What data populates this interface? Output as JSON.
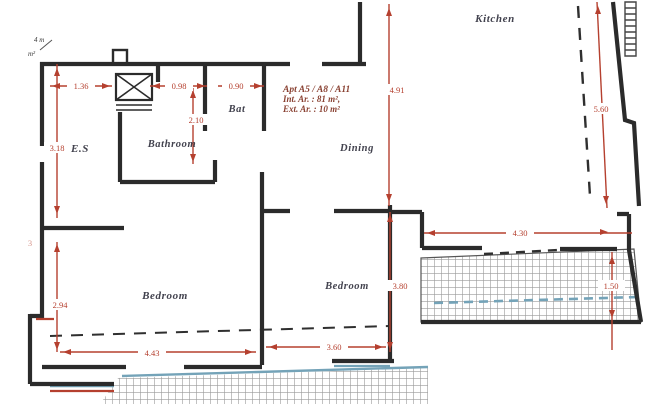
{
  "plan": {
    "rooms": {
      "kitchen": "Kitchen",
      "dining": "Dining",
      "bathroom": "Bathroom",
      "bat": "Bat",
      "es": "E.S",
      "bedroom1": "Bedroom",
      "bedroom2": "Bedroom"
    },
    "annotation": {
      "line1": "Apt A5 / A8 / A11",
      "line2": "Int. Ar. : 81 m²,",
      "line3": "Ext. Ar. : 10 m²"
    },
    "dimensions": {
      "d136": "1.36",
      "d098": "0.98",
      "d090": "0.90",
      "d210": "2.10",
      "d318": "3.18",
      "d294": "2.94",
      "d443": "4.43",
      "d360": "3.60",
      "d380": "3.80",
      "d491": "4.91",
      "d430": "4.30",
      "d560": "5.60",
      "d150": "1.50",
      "dleft": "3"
    },
    "fragments": {
      "top1": "4 m",
      "top2": "m²"
    },
    "colors": {
      "wall": "#2b2b2b",
      "dimension_red": "#b5402f",
      "annotation_red": "#8a4233",
      "room_label": "#42424e",
      "accent_blue": "#74a3b8",
      "hatch_gray": "#9a9a9a",
      "background": "#ffffff"
    }
  }
}
